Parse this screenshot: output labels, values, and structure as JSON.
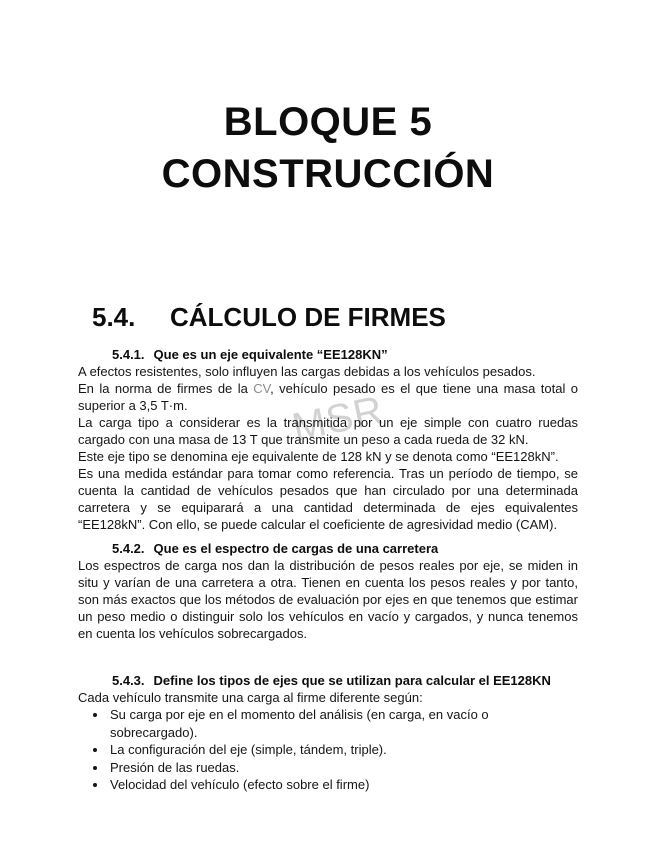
{
  "watermark": {
    "text": "MSR"
  },
  "doc_title": {
    "line1": "BLOQUE 5",
    "line2": "CONSTRUCCIÓN"
  },
  "section": {
    "number": "5.4.",
    "title": "CÁLCULO DE FIRMES"
  },
  "s1": {
    "number": "5.4.1.",
    "heading": "Que es un eje equivalente “EE128KN”",
    "p1": "A efectos resistentes, solo influyen las cargas debidas a los vehículos pesados.",
    "p2a": "En la norma de firmes de la ",
    "p2b": "CV",
    "p2c": ", vehículo pesado es el que tiene una masa total o superior a 3,5 T·m.",
    "p3": "La carga tipo a considerar es la transmitida por un eje simple con cuatro ruedas cargado con una masa de 13 T que transmite un peso a cada rueda de 32 kN.",
    "p4": "Este eje tipo se denomina eje equivalente de 128 kN y se denota como “EE128kN”.",
    "p5": "Es una medida estándar para tomar como referencia. Tras un período de tiempo, se cuenta la cantidad de vehículos pesados que han circulado por una determinada carretera y se equiparará a una cantidad determinada de ejes equivalentes “EE128kN”. Con ello, se puede calcular el coeficiente de agresividad medio (CAM)."
  },
  "s2": {
    "number": "5.4.2.",
    "heading": "Que es el espectro de cargas de una carretera",
    "p1": "Los espectros de carga nos dan la distribución de pesos reales por eje, se miden in situ y varían de una carretera a otra. Tienen en cuenta los pesos reales y por tanto, son más exactos que los métodos de evaluación por ejes en que tenemos que estimar un peso medio o distinguir solo los vehículos en vacío y cargados, y nunca tenemos en cuenta los vehículos sobrecargados."
  },
  "s3": {
    "number": "5.4.3.",
    "heading": "Define los tipos de ejes que se utilizan para calcular el EE128KN",
    "intro": "Cada vehículo transmite una carga al firme diferente según:",
    "bullets": [
      "Su carga por eje en el momento del análisis (en carga, en vacío o sobrecargado).",
      "La configuración del eje (simple, tándem, triple).",
      "Presión de las ruedas.",
      "Velocidad del vehículo (efecto sobre el firme)"
    ]
  },
  "colors": {
    "text": "#151515",
    "watermark_gray": "#7d7d7d"
  }
}
